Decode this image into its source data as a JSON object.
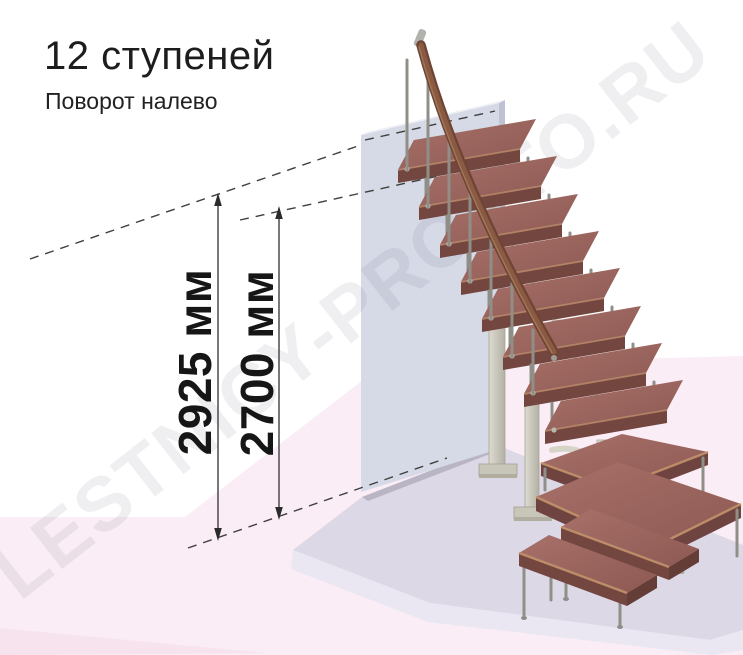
{
  "title": "12 ступеней",
  "subtitle": "Поворот налево",
  "watermark": "LESTNICY-PROSTO.RU",
  "dimensions": {
    "total_height": "2925 мм",
    "to_top_step": "2700 мм"
  },
  "stair": {
    "steps_total": 12,
    "turn": "налево",
    "straight_flight_steps": 8,
    "winder_steps": 2,
    "bottom_steps": 2
  },
  "colors": {
    "tread_top": "#9a655e",
    "tread_front": "#73463f",
    "handrail": "#7a4c38",
    "metal": "#c9c6ba",
    "wall": "#d6d9e6",
    "platform": "#dcd8e6",
    "floor_pink": "#faedf5",
    "dimension_line": "#3f3f3f",
    "watermark_gray": "#ececec"
  }
}
